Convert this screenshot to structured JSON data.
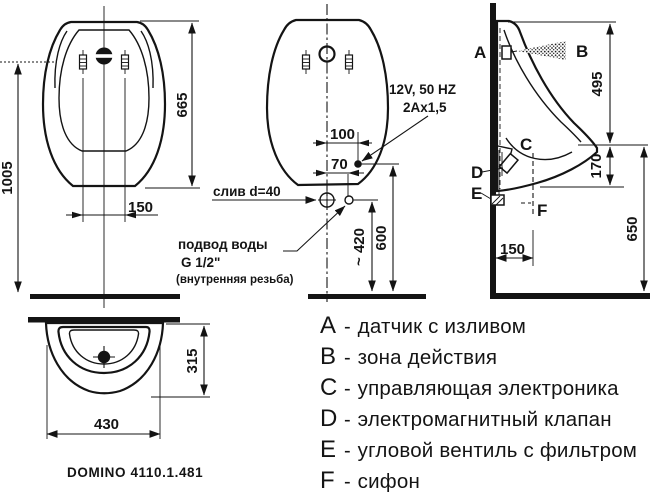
{
  "product": {
    "model_label": "DOMINO 4110.1.481"
  },
  "front_view": {
    "dim_total_height": "1005",
    "dim_body_height": "665",
    "dim_hole_spacing": "150"
  },
  "rear_view": {
    "dim_elec_offset": "100",
    "dim_inlet_offset": "70",
    "dim_inlet_height": "~ 420",
    "dim_elec_height": "600",
    "label_power": "12V, 50 HZ",
    "label_cable": "2Ax1,5",
    "label_drain": "слив d=40",
    "label_water_supply": "подвод воды",
    "label_water_thread": "G 1/2\"",
    "label_water_note": "(внутренняя резьба)"
  },
  "side_view": {
    "dim_sensor_height": "495",
    "dim_bowl_depth": "170",
    "dim_outlet_height": "650",
    "dim_wall_offset": "150",
    "marker_a": "A",
    "marker_b": "B",
    "marker_c": "C",
    "marker_d": "D",
    "marker_e": "E",
    "marker_f": "F"
  },
  "plan_view": {
    "dim_depth": "315",
    "dim_width": "430"
  },
  "legend": {
    "separator": "-",
    "items": [
      {
        "letter": "A",
        "text": "датчик с изливом"
      },
      {
        "letter": "B",
        "text": "зона действия"
      },
      {
        "letter": "C",
        "text": "управляющая электроника"
      },
      {
        "letter": "D",
        "text": "электромагнитный клапан"
      },
      {
        "letter": "E",
        "text": "угловой вентиль с фильтром"
      },
      {
        "letter": "F",
        "text": "сифон"
      }
    ]
  },
  "colors": {
    "ink": "#141414",
    "paper": "#ffffff"
  }
}
